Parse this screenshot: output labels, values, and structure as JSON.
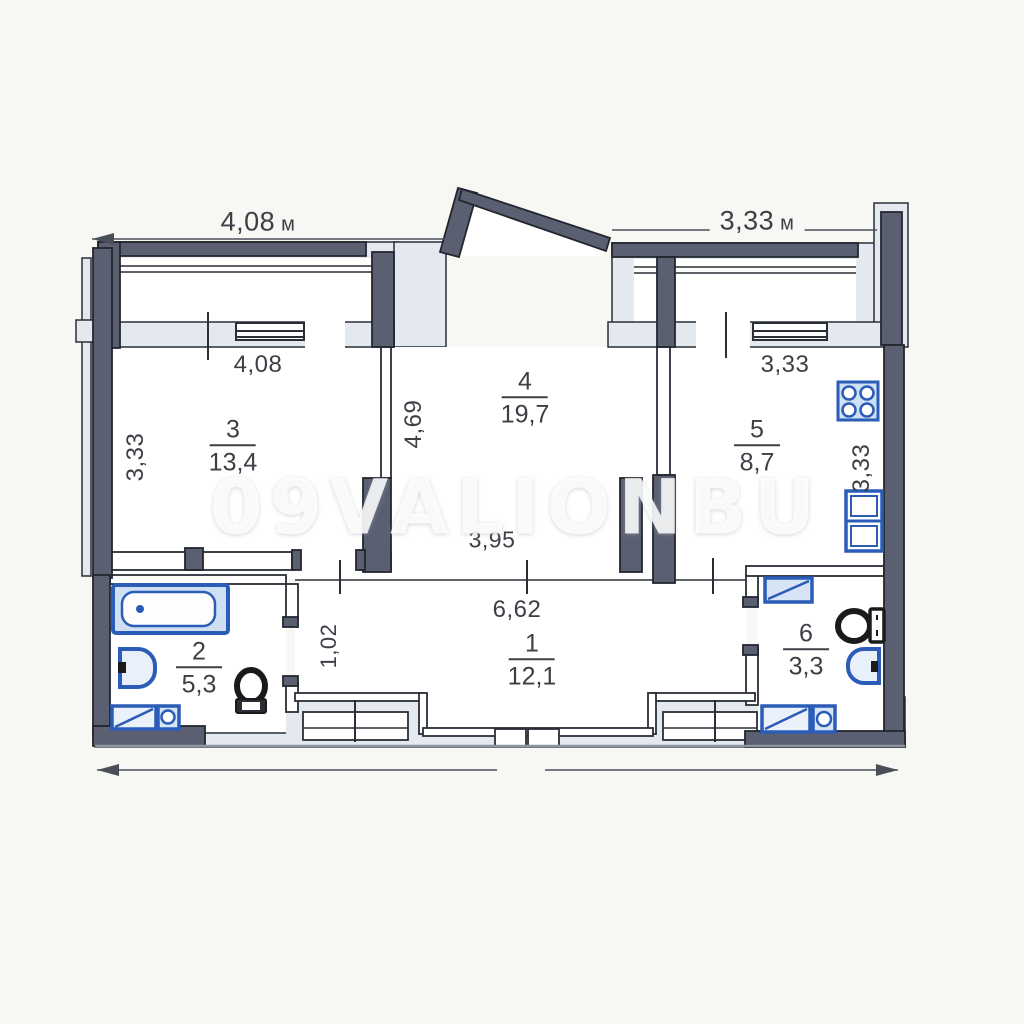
{
  "watermark": "09VALIONBU",
  "dims": {
    "top_left": {
      "value": "4,08",
      "unit": "м"
    },
    "top_right": {
      "value": "3,33",
      "unit": "м"
    },
    "room3_width": "4,08",
    "room3_depth": "3,33",
    "room4_depth": "4,69",
    "room4_opening": "3,95",
    "kitchen_width": "3,33",
    "kitchen_depth": "3,33",
    "hall_width": "6,62",
    "hall_corridor": "1,02"
  },
  "rooms": {
    "r1": {
      "number": "1",
      "area": "12,1"
    },
    "r2": {
      "number": "2",
      "area": "5,3"
    },
    "r3": {
      "number": "3",
      "area": "13,4"
    },
    "r4": {
      "number": "4",
      "area": "19,7"
    },
    "r5": {
      "number": "5",
      "area": "8,7"
    },
    "r6": {
      "number": "6",
      "area": "3,3"
    }
  },
  "colors": {
    "wall": "#5a6072",
    "line": "#2a2e36",
    "light_zone": "#e4e9f0",
    "fixture_blue": "#2a5cb8",
    "fixture_fill": "#d6e4f6"
  },
  "icons": {
    "bathtub": "bathtub-icon",
    "sink": "sink-icon",
    "toilet": "toilet-icon",
    "washing_machine": "washing-machine-icon",
    "stove": "stove-icon",
    "kitchen_sink": "kitchen-sink-icon"
  }
}
